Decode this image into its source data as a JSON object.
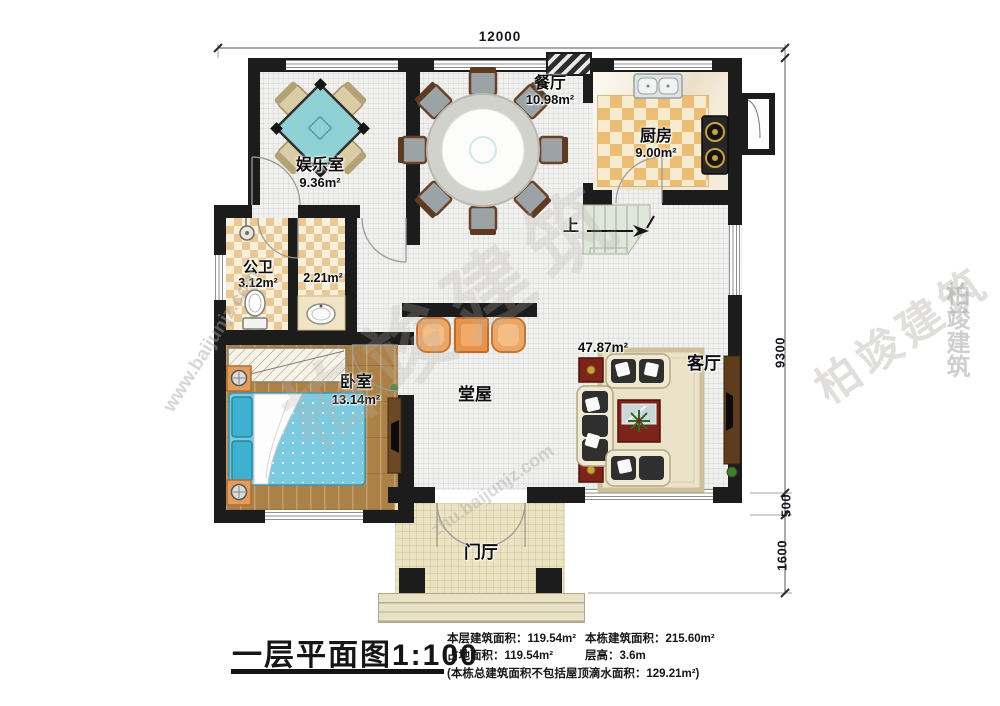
{
  "dimensions": {
    "top": "12000",
    "right_top": "9300",
    "right_mid": "500",
    "right_bottom": "1600"
  },
  "rooms": {
    "entertainment": {
      "name": "娱乐室",
      "area": "9.36m²"
    },
    "dining": {
      "name": "餐厅",
      "area": "10.98m²"
    },
    "kitchen": {
      "name": "厨房",
      "area": "9.00m²"
    },
    "bathroom": {
      "name": "公卫",
      "area": "3.12m²"
    },
    "washroom": {
      "area": "2.21m²"
    },
    "bedroom": {
      "name": "卧室",
      "area": "13.14m²"
    },
    "hall": {
      "name": "堂屋"
    },
    "living": {
      "name": "客厅",
      "area": "47.87m²"
    },
    "foyer": {
      "name": "门厅"
    }
  },
  "stairs": {
    "up_label": "上"
  },
  "title_block": {
    "title": "一层平面图",
    "scale": "1:100",
    "stats": [
      {
        "label": "本层建筑面积：",
        "value": "119.54m²"
      },
      {
        "label": "占地面积：",
        "value": "119.54m²"
      },
      {
        "label": "本栋建筑面积：",
        "value": "215.60m²"
      },
      {
        "label": "层高：",
        "value": "3.6m"
      }
    ],
    "note": "(本栋总建筑面积不包括屋顶滴水面积：129.21m²)"
  },
  "watermarks": {
    "brand": "柏竣建筑",
    "site": "www.baijunjz.com",
    "site2": "zhu.baijunjz.com"
  },
  "colors": {
    "wall": "#1c1c1c",
    "kitchen_checker": "#ecbd74",
    "bath_checker": "#eac896",
    "wood_floor": "#ab8148",
    "bed": "#7ccadf",
    "mahjong_table": "#90d1d3",
    "cushion_orange": "#eaa766",
    "sofa_beige": "#efe8d2",
    "table_red": "#7c231a",
    "stairs": "#dfe6da",
    "porch_floor": "#ebe3c2"
  }
}
